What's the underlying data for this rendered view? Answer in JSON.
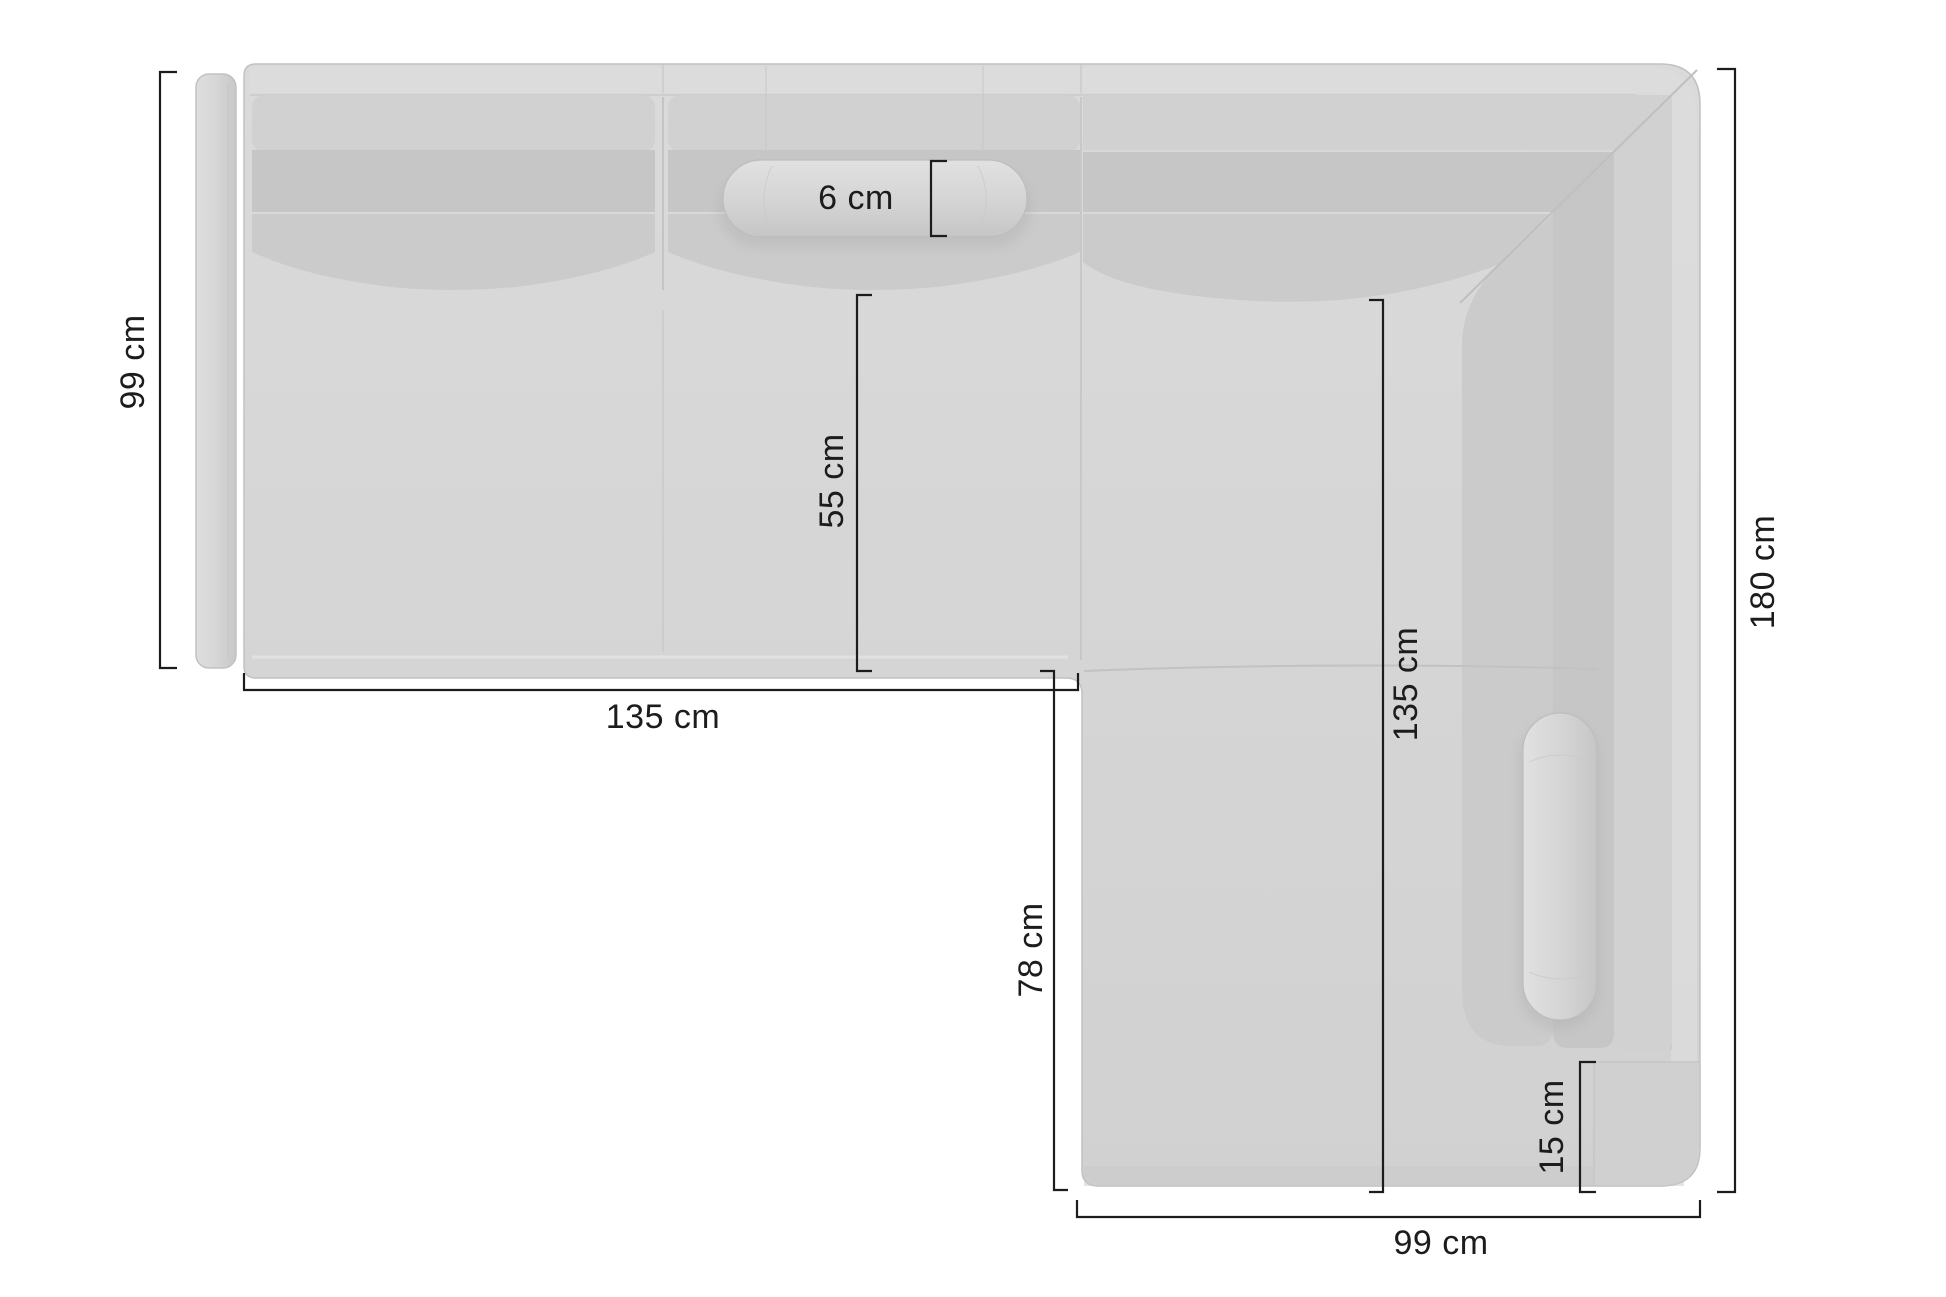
{
  "diagram": {
    "name": "corner-sofa-top-view-dimension-diagram",
    "background": "#ffffff"
  },
  "style": {
    "dimension_line_color": "#1c1c1c",
    "text_color": "#1c1c1c",
    "sofa_base_fill": "#d5d5d5",
    "sofa_light_fill": "#dedede",
    "sofa_cushion_fill": "#c6c6c6",
    "sofa_outline": "#c1c1c1"
  },
  "sofa": {
    "parts": [
      "left-armrest-panel",
      "left-seat",
      "middle-seat",
      "corner-seat",
      "chaise-section",
      "right-backrest",
      "right-armrest-block",
      "headrest-bolster-pillow",
      "side-bolster-pillow"
    ]
  },
  "dimensions": [
    {
      "id": "left-section-depth",
      "label": "99 cm",
      "orientation": "vertical"
    },
    {
      "id": "headrest-pillow-thickness",
      "label": "6 cm",
      "orientation": "horizontal"
    },
    {
      "id": "seat-depth",
      "label": "55 cm",
      "orientation": "vertical"
    },
    {
      "id": "left-section-width",
      "label": "135 cm",
      "orientation": "horizontal"
    },
    {
      "id": "chaise-inner-length",
      "label": "78 cm",
      "orientation": "vertical"
    },
    {
      "id": "right-section-inner-length",
      "label": "135 cm",
      "orientation": "vertical"
    },
    {
      "id": "armrest-width",
      "label": "15 cm",
      "orientation": "vertical"
    },
    {
      "id": "chaise-width",
      "label": "99 cm",
      "orientation": "horizontal"
    },
    {
      "id": "right-section-length",
      "label": "180 cm",
      "orientation": "vertical"
    }
  ]
}
